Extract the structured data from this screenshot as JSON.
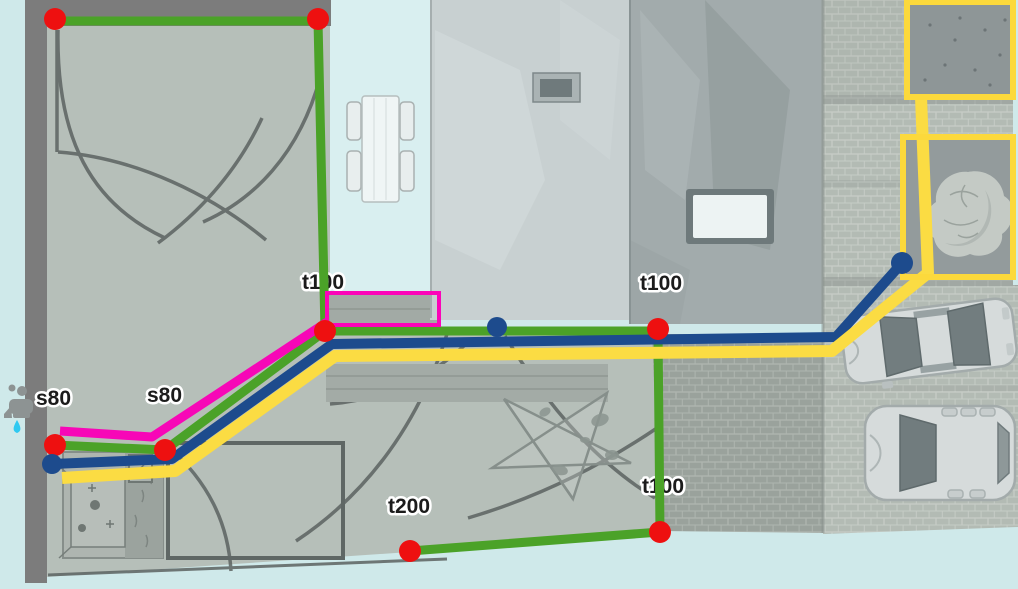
{
  "canvas": {
    "width": 1018,
    "height": 589
  },
  "palette": {
    "line_green": "#4ba228",
    "line_navy": "#1d4b8d",
    "line_yellow": "#fbdc43",
    "line_magenta": "#f707b7",
    "node_red": "#ee1010",
    "node_blue": "#1d4b8d",
    "zone_yellow": "#fcd93c",
    "selection_magenta": "#fb04b8",
    "label_color": "#1b1b1b",
    "label_halo": "#ffffff"
  },
  "labels": [
    {
      "id": "label-t100-terrace",
      "text": "t100",
      "x": 302,
      "y": 289
    },
    {
      "id": "label-t100-roof",
      "text": "t100",
      "x": 640,
      "y": 290
    },
    {
      "id": "label-t100-lower",
      "text": "t100",
      "x": 642,
      "y": 493
    },
    {
      "id": "label-t200",
      "text": "t200",
      "x": 388,
      "y": 513
    },
    {
      "id": "label-s80-right",
      "text": "s80",
      "x": 147,
      "y": 402
    },
    {
      "id": "label-s80-left",
      "text": "s80",
      "x": 36,
      "y": 405
    }
  ],
  "pipes": [
    {
      "id": "pipe-green-top-boundary",
      "color": "line_green",
      "width": 9,
      "points": [
        [
          55,
          21
        ],
        [
          318,
          21
        ],
        [
          325,
          331
        ]
      ]
    },
    {
      "id": "pipe-green-main",
      "color": "line_green",
      "width": 9,
      "points": [
        [
          55,
          445
        ],
        [
          165,
          450
        ],
        [
          325,
          331
        ],
        [
          658,
          331
        ]
      ]
    },
    {
      "id": "pipe-green-right-branch",
      "color": "line_green",
      "width": 9,
      "points": [
        [
          658,
          331
        ],
        [
          660,
          532
        ],
        [
          410,
          551
        ]
      ]
    },
    {
      "id": "pipe-magenta",
      "color": "line_magenta",
      "width": 9,
      "points": [
        [
          60,
          431
        ],
        [
          152,
          437
        ],
        [
          327,
          322
        ]
      ]
    },
    {
      "id": "pipe-navy",
      "color": "line_navy",
      "width": 10,
      "points": [
        [
          52,
          464
        ],
        [
          172,
          459
        ],
        [
          332,
          344
        ],
        [
          836,
          337
        ],
        [
          902,
          263
        ]
      ]
    },
    {
      "id": "pipe-yellow",
      "color": "line_yellow",
      "width": 12,
      "points": [
        [
          62,
          478
        ],
        [
          175,
          471
        ],
        [
          335,
          356
        ],
        [
          832,
          351
        ],
        [
          928,
          273
        ],
        [
          921,
          97
        ]
      ]
    }
  ],
  "nodes": [
    {
      "type": "red",
      "x": 55,
      "y": 19,
      "r": 11
    },
    {
      "type": "red",
      "x": 318,
      "y": 19,
      "r": 11
    },
    {
      "type": "red",
      "x": 325,
      "y": 331,
      "r": 11
    },
    {
      "type": "red",
      "x": 55,
      "y": 445,
      "r": 11
    },
    {
      "type": "red",
      "x": 165,
      "y": 450,
      "r": 11
    },
    {
      "type": "red",
      "x": 658,
      "y": 329,
      "r": 11
    },
    {
      "type": "red",
      "x": 660,
      "y": 532,
      "r": 11
    },
    {
      "type": "red",
      "x": 410,
      "y": 551,
      "r": 11
    },
    {
      "type": "blue",
      "x": 52,
      "y": 464,
      "r": 10
    },
    {
      "type": "blue",
      "x": 497,
      "y": 327,
      "r": 10
    },
    {
      "type": "blue",
      "x": 902,
      "y": 263,
      "r": 11
    }
  ],
  "zones": [
    {
      "x": 907,
      "y": 2,
      "width": 106,
      "height": 95
    },
    {
      "x": 903,
      "y": 137,
      "width": 110,
      "height": 140
    }
  ],
  "selection": {
    "x": 327,
    "y": 293,
    "width": 112,
    "height": 32
  }
}
